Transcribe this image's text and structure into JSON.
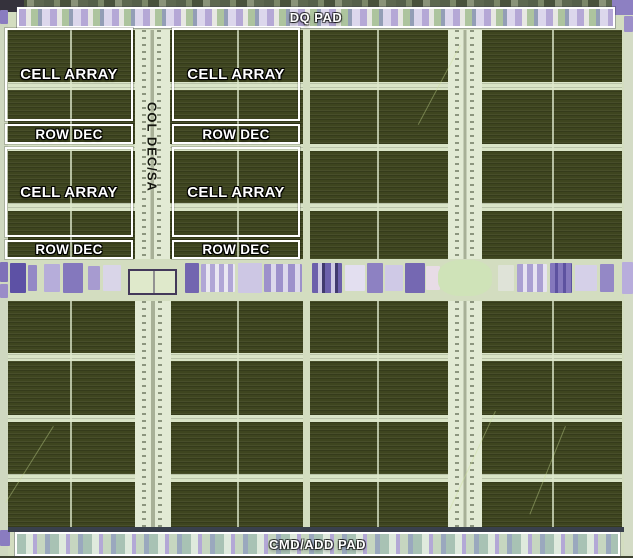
{
  "pads": {
    "top_label": "DQ PAD",
    "bottom_label": "CMD/ADD PAD"
  },
  "labels": {
    "column_decoder": "COL DEC/SA"
  },
  "banks": {
    "left": {
      "blocks": [
        {
          "label": "CELL ARRAY"
        },
        {
          "label": "ROW DEC"
        },
        {
          "label": "CELL ARRAY"
        },
        {
          "label": "ROW DEC"
        }
      ]
    },
    "right": {
      "blocks": [
        {
          "label": "CELL ARRAY"
        },
        {
          "label": "ROW DEC"
        },
        {
          "label": "CELL ARRAY"
        },
        {
          "label": "ROW DEC"
        }
      ]
    }
  },
  "colors": {
    "cell_array_block": "#3e451f",
    "light_channel": "#d9e4c6",
    "column_decoder_strip": "#e2ead4",
    "annotation_border": "#ffffff",
    "annotation_text": "#ffffff",
    "column_decoder_text": "#14160f",
    "pad_lavender": "#b5a8d6",
    "pad_green": "#adc49e",
    "periphery_purple": "#7568b2"
  }
}
